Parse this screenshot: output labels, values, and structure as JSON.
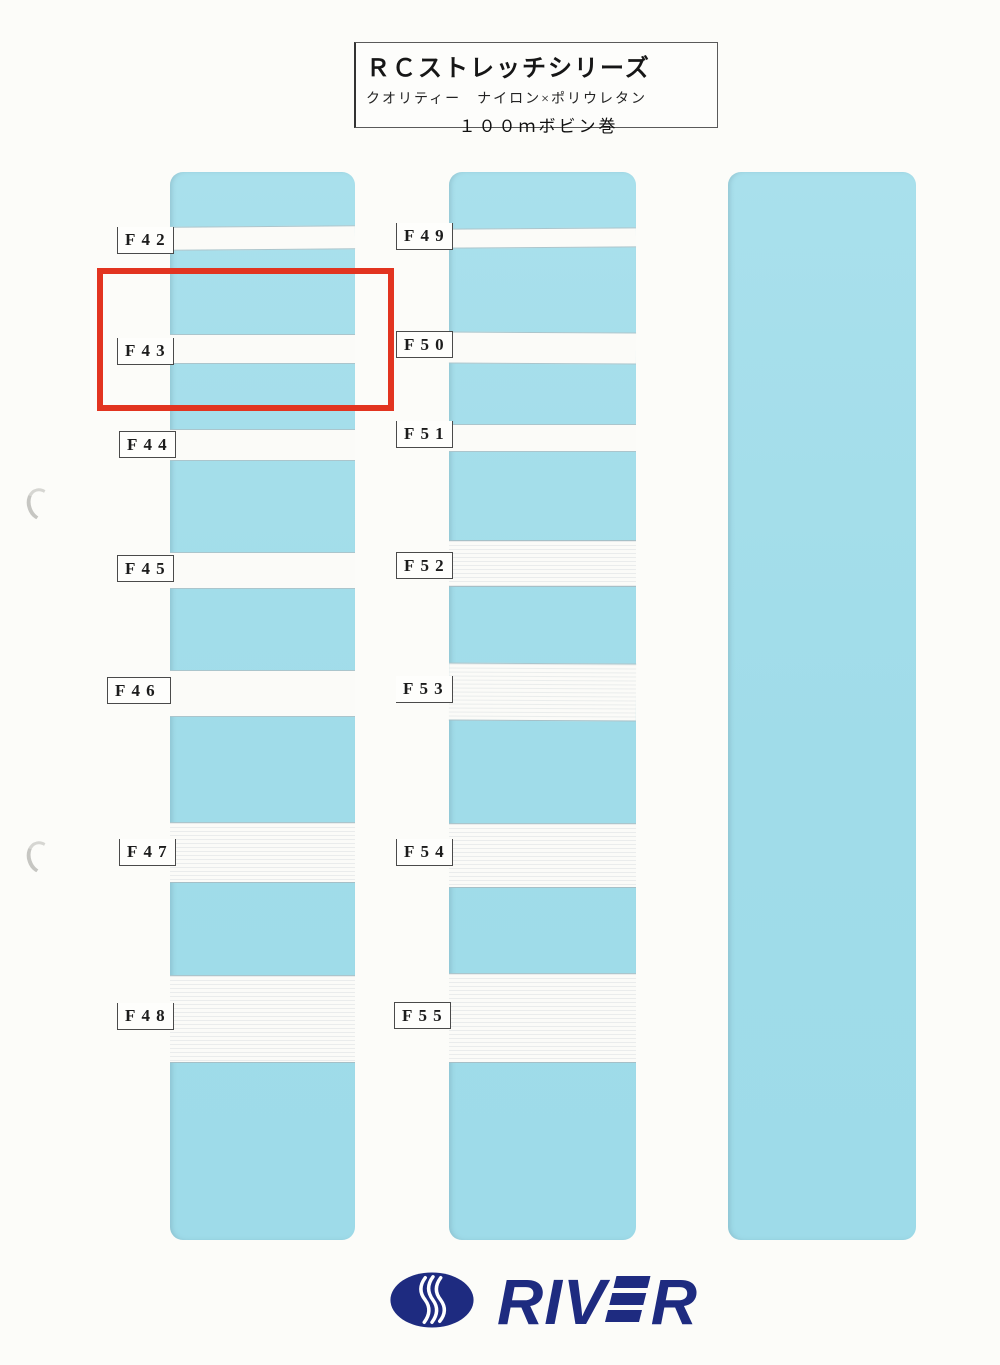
{
  "header": {
    "series_title": "ＲＣストレッチシリーズ",
    "quality_line": "クオリティー　ナイロン×ポリウレタン",
    "spool_line": "１００ｍボビン巻"
  },
  "samples": {
    "left_column": [
      "F42",
      "F43",
      "F44",
      "F45",
      "F46",
      "F47",
      "F48"
    ],
    "right_column": [
      "F49",
      "F50",
      "F51",
      "F52",
      "F53",
      "F54",
      "F55"
    ]
  },
  "highlight": {
    "highlighted_code": "F43",
    "color": "#e23420"
  },
  "logo": {
    "prefix": "RIV",
    "suffix": "R",
    "full_name": "RIVER",
    "color": "#1e2b80"
  },
  "colors": {
    "panel_blue": "#a4ddea",
    "tape_white": "#fbfbf8",
    "page_background": "#fcfcf9",
    "tag_border": "#4a4a4a"
  }
}
